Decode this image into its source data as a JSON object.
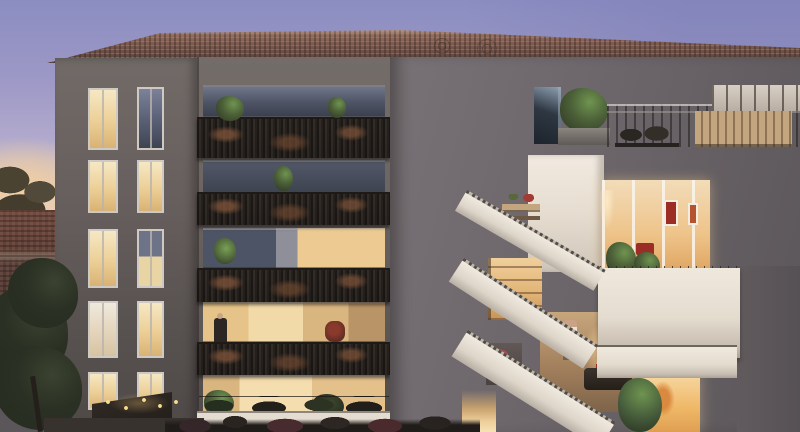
{
  "scene": {
    "type": "architectural-rendering",
    "time_of_day": "dusk",
    "subject": "modern residential apartment building",
    "left_block_floors": 5,
    "mid_balcony_levels": 4,
    "right_terrace_levels": 3,
    "visible_people": 4,
    "features": [
      "terracotta-tile-roof",
      "rooftop-terrace",
      "ornate-metal-railings",
      "white-terraced-balconies",
      "warm-lit-interiors",
      "balcony-plants",
      "foreground-tree",
      "string-lights",
      "sunset-sky"
    ]
  },
  "palette": {
    "sky-top": "#8b8dc1",
    "sky-mid": "#b3abcd",
    "sky-horizon": "#ead9d2",
    "sunset": "#f2cf9e",
    "roof-base": "#7c5a4e",
    "roof-dark": "#4f3c36",
    "roof-light": "#a8806c",
    "facade-top": "#716a67",
    "facade-bottom": "#4e4947",
    "mid-wall": "#6e6764",
    "wing-top": "#787175",
    "wing-bottom": "#5b5659",
    "slab-light": "#efe8dd",
    "slab-shadow": "#aba294",
    "rail-dark": "#2e2925",
    "rail-rust": "#7a5138",
    "glass-blue": "#7b8299",
    "lit-warm": "#f3ddb0",
    "lit-deep": "#dfa967",
    "plant-dark": "#2c3423",
    "plant-mid": "#4c6038",
    "plant-bright": "#6f9450",
    "tree-dark": "#262b20",
    "neighbor-roof": "#5d4038",
    "wood-light": "#c3a57f",
    "accent-red": "#9c2d24",
    "figure-dark": "#2c2723",
    "parapet": "#e4dcd0"
  }
}
